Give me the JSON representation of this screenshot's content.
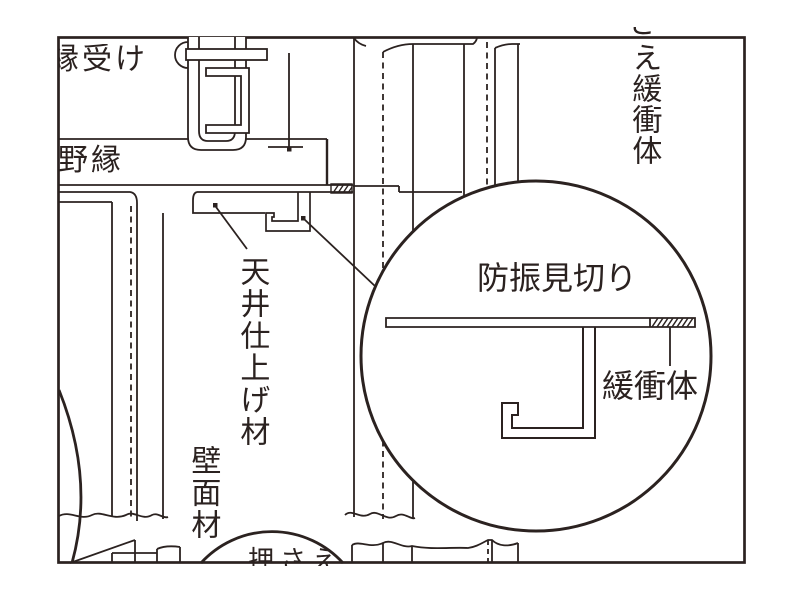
{
  "drawing": {
    "kind": "ceiling-wall joint construction detail (CAD line drawing)",
    "colors": {
      "line": "#2b2220",
      "background": "#ffffff"
    },
    "labels": {
      "hanger": "縁受け",
      "joist": "野縁",
      "ceiling_finish": "天井仕上げ材",
      "wall_panel": "壁面材",
      "top_right_fragment": "さ",
      "top_right": "え緩衝体",
      "detail_title": "防振見切り",
      "detail_buffer": "緩衝体",
      "bottom": "押さえ"
    }
  }
}
